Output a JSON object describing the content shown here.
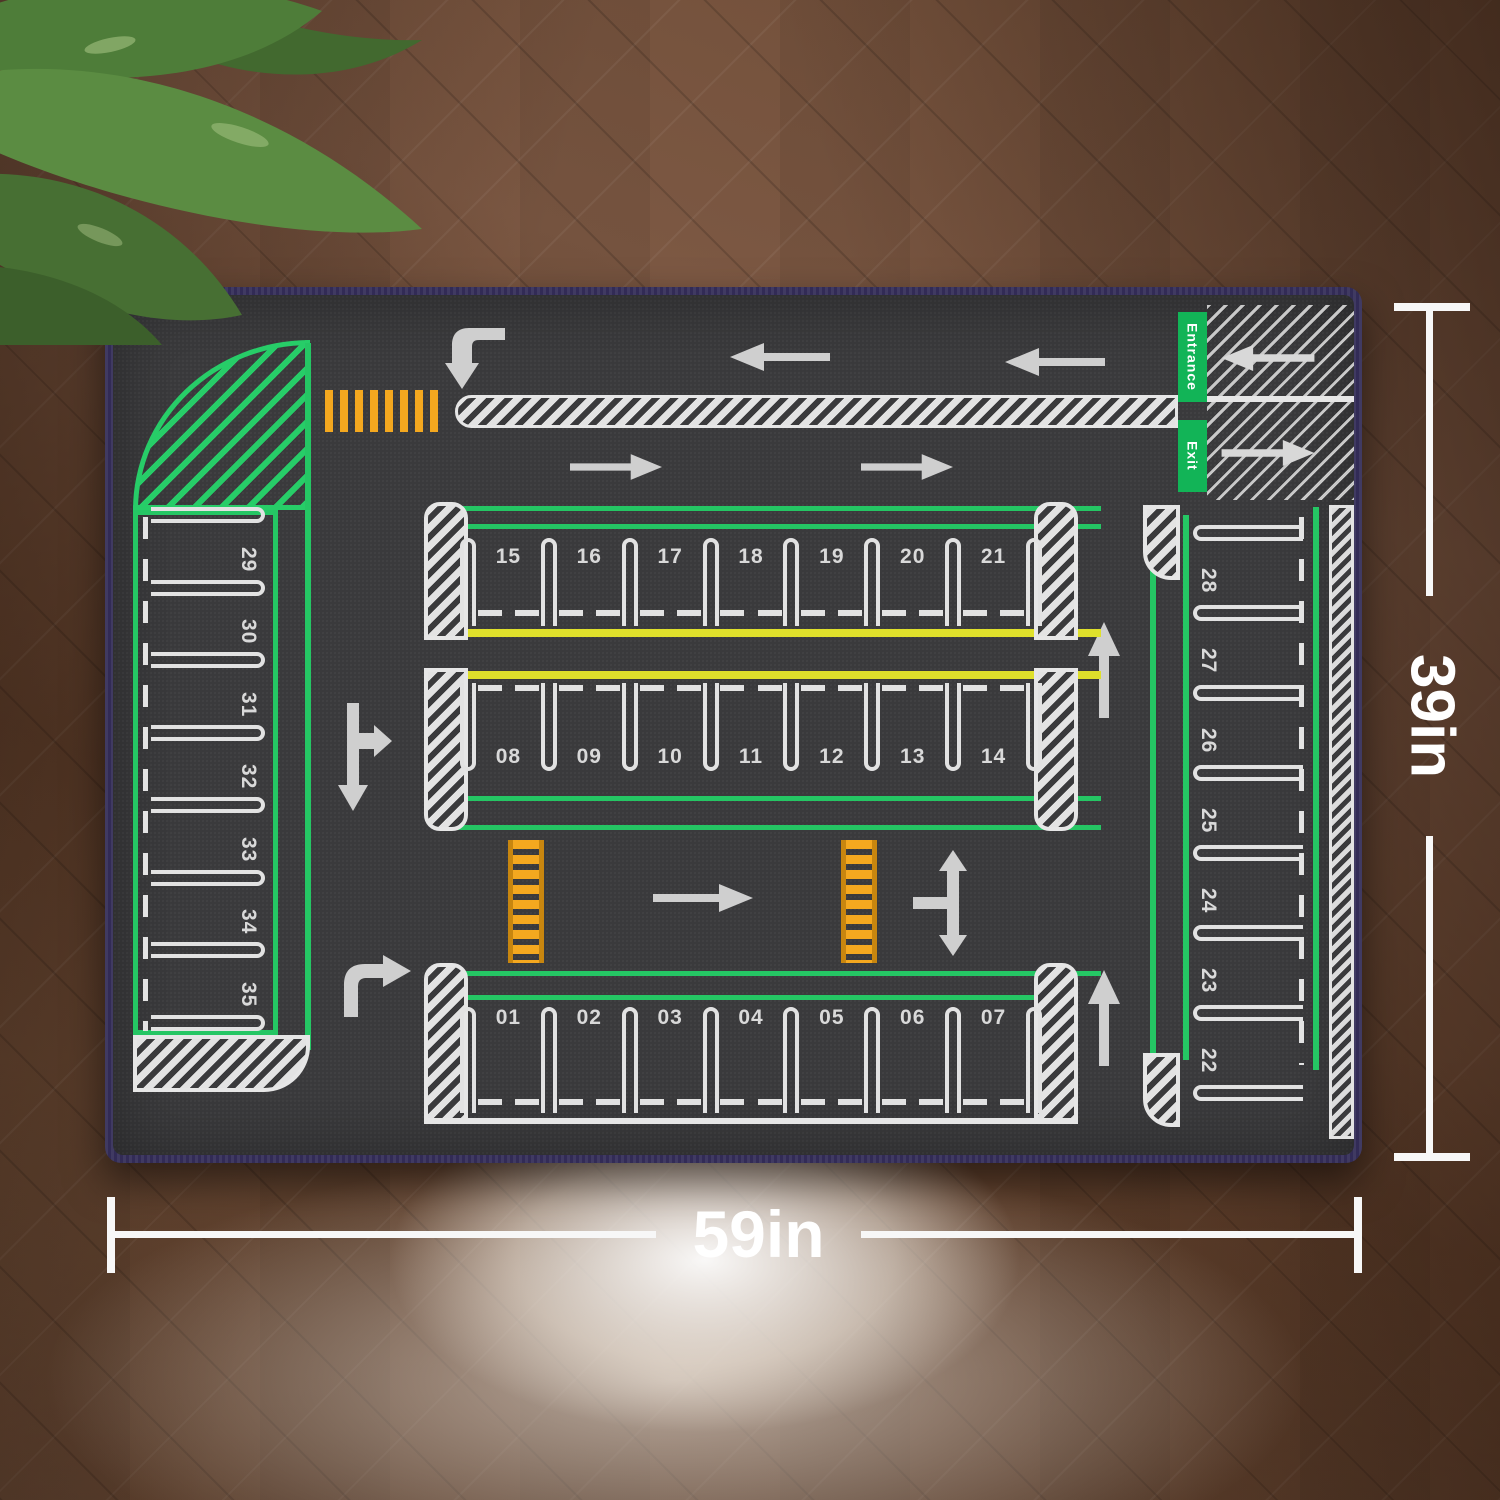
{
  "scene": {
    "floor_color": "#6e4b36",
    "mat_surface_color": "#3a3a3c",
    "mat_binding_color": "#322b56"
  },
  "mat": {
    "entrance_label": "Entrance",
    "exit_label": "Exit",
    "line_colors": {
      "green": "#25c664",
      "yellow": "#dfe02b",
      "orange": "#f4a81f",
      "white": "#e6e6e6"
    },
    "spaces": {
      "top_row": [
        "15",
        "16",
        "17",
        "18",
        "19",
        "20",
        "21"
      ],
      "middle_row": [
        "08",
        "09",
        "10",
        "11",
        "12",
        "13",
        "14"
      ],
      "bottom_row": [
        "01",
        "02",
        "03",
        "04",
        "05",
        "06",
        "07"
      ],
      "left_column": [
        "29",
        "30",
        "31",
        "32",
        "33",
        "34",
        "35"
      ],
      "right_column": [
        "28",
        "27",
        "26",
        "25",
        "24",
        "23",
        "22"
      ]
    },
    "icons": [
      "turn-down-arrow",
      "turn-right-arrow",
      "left-arrow",
      "right-arrow",
      "up-arrow",
      "branch-right-down-arrow",
      "three-way-arrow",
      "crosswalk",
      "ladder-crosswalk"
    ]
  },
  "dimensions": {
    "width_label": "59in",
    "height_label": "39in"
  }
}
